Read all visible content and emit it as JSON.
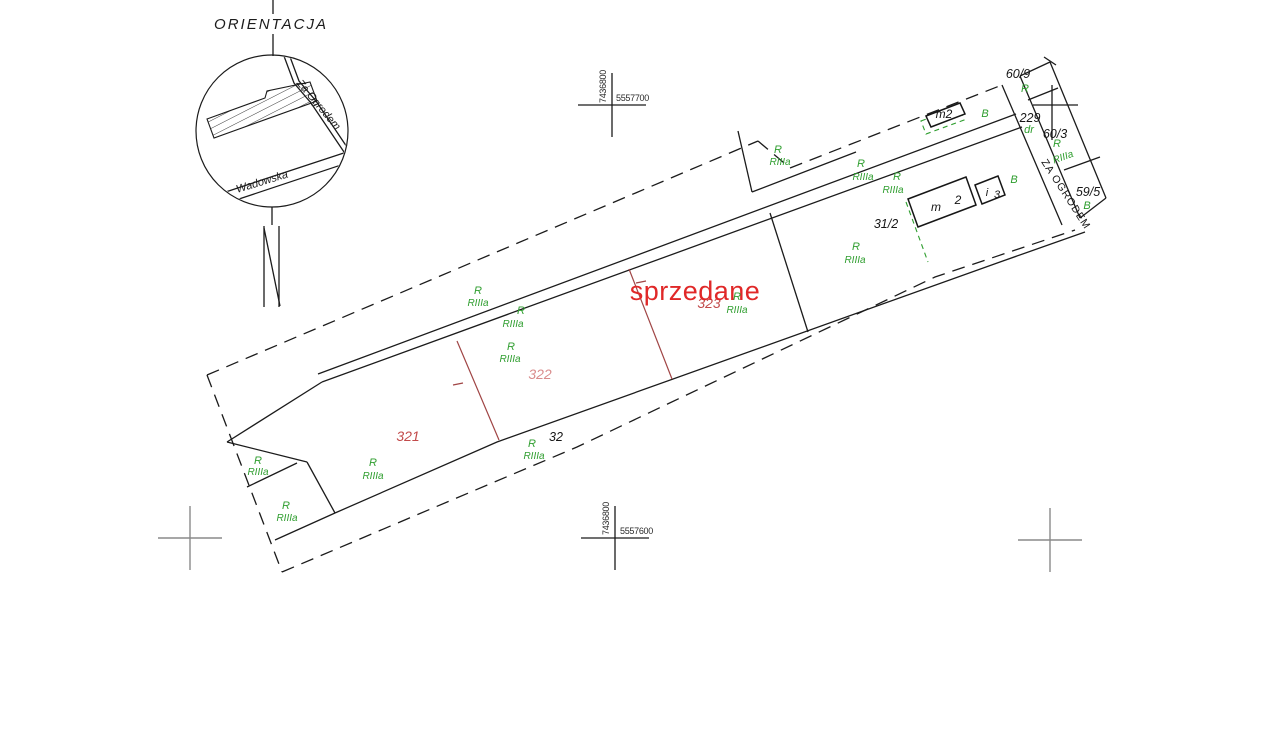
{
  "inset": {
    "title": "ORIENTACJA",
    "street_za_ogrodem": "Za Ogrodem",
    "street_wadowska": "Wadowska"
  },
  "grid_crosses": {
    "northing": "7436800",
    "easting_top": "5557700",
    "easting_bottom": "5557600"
  },
  "status": {
    "sold_label": "sprzedane"
  },
  "parcels": {
    "321": "321",
    "322": "322",
    "323": "323",
    "32": "32",
    "31_2": "31/2",
    "229": "229",
    "60_9": "60/9",
    "60_3": "60/3",
    "59_5": "59/5"
  },
  "land_use": {
    "arable": "R",
    "soil_class": "RIIIa",
    "built": "B",
    "road": "dr"
  },
  "road_name": "ZA OGRODEM",
  "buildings": {
    "small": "m2",
    "main_letter": "m",
    "main_storeys": "2",
    "annex_letter": "i",
    "annex_storeys": "3"
  },
  "colors": {
    "sold_text": "#e02828",
    "parcel_number_red": "#c24b4b",
    "land_use_green": "#2f9e2f",
    "division_line_red": "#a04545",
    "boundary_line": "#1b1b1b",
    "grid_cross_gray": "#8a8a8a"
  }
}
